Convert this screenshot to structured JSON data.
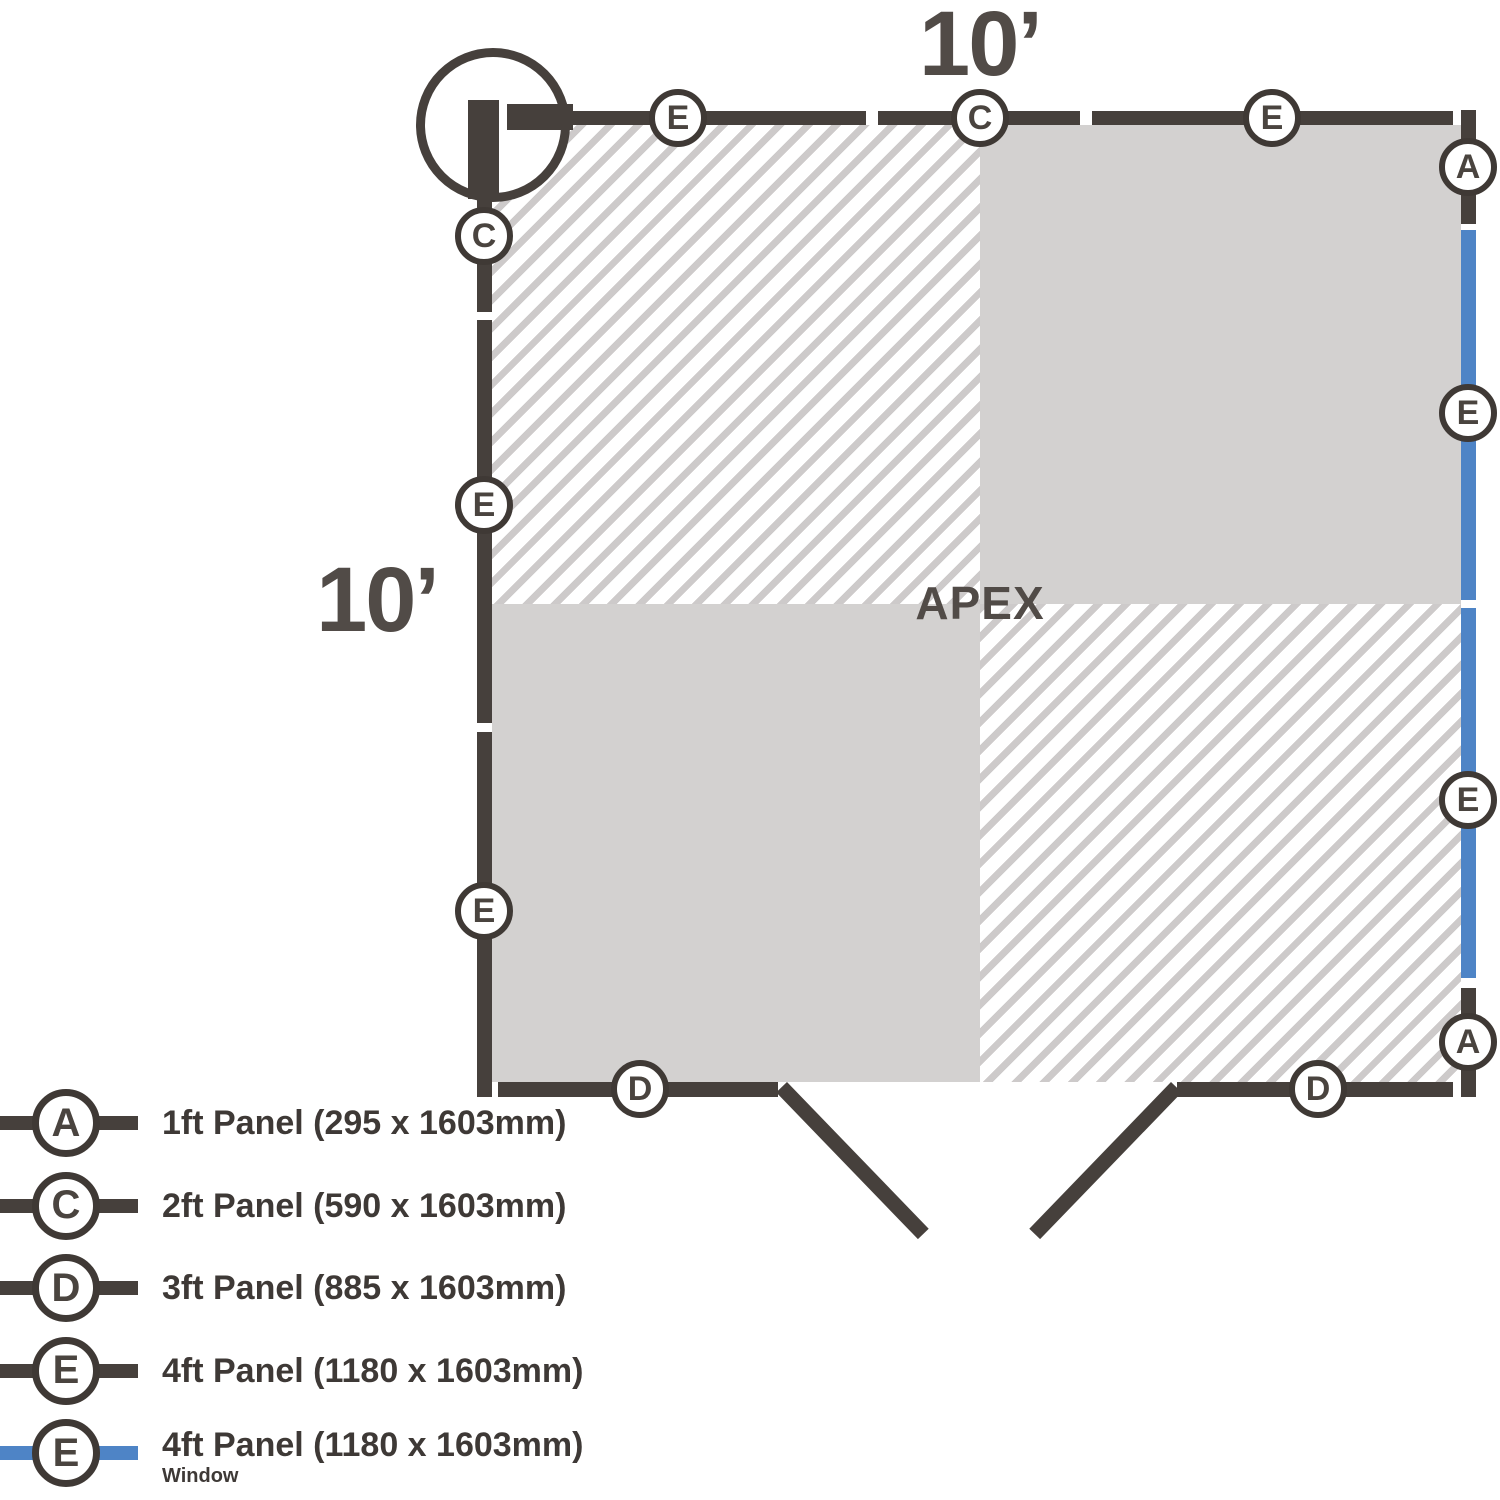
{
  "diagram": {
    "top_dimension": "10’",
    "left_dimension": "10’",
    "apex_label": "APEX"
  },
  "colors": {
    "wall": "#46403C",
    "window": "#4E84C6",
    "floor": "#D3D1D0",
    "hatch": "#CDCACA",
    "text": "#514B47",
    "legend_text": "#3E3936"
  },
  "markers": [
    {
      "letter": "E",
      "side": "top",
      "x": 678,
      "y": 118
    },
    {
      "letter": "C",
      "side": "top",
      "x": 980,
      "y": 118
    },
    {
      "letter": "E",
      "side": "top",
      "x": 1272,
      "y": 118
    },
    {
      "letter": "A",
      "side": "right",
      "x": 1468,
      "y": 167
    },
    {
      "letter": "E",
      "side": "right",
      "x": 1468,
      "y": 413
    },
    {
      "letter": "E",
      "side": "right",
      "x": 1468,
      "y": 800
    },
    {
      "letter": "A",
      "side": "right",
      "x": 1468,
      "y": 1042
    },
    {
      "letter": "C",
      "side": "left",
      "x": 484,
      "y": 236
    },
    {
      "letter": "E",
      "side": "left",
      "x": 484,
      "y": 505
    },
    {
      "letter": "E",
      "side": "left",
      "x": 484,
      "y": 911
    },
    {
      "letter": "D",
      "side": "bottom",
      "x": 640,
      "y": 1089
    },
    {
      "letter": "D",
      "side": "bottom",
      "x": 1318,
      "y": 1089
    }
  ],
  "legend": {
    "items": [
      {
        "letter": "A",
        "label": "1ft Panel (295 x 1603mm)",
        "line": "wall"
      },
      {
        "letter": "C",
        "label": "2ft Panel (590 x 1603mm)",
        "line": "wall"
      },
      {
        "letter": "D",
        "label": "3ft Panel (885 x 1603mm)",
        "line": "wall"
      },
      {
        "letter": "E",
        "label": "4ft Panel (1180 x 1603mm)",
        "line": "wall"
      },
      {
        "letter": "E",
        "label": "4ft Panel (1180 x 1603mm)",
        "sublabel": "Window",
        "line": "window"
      }
    ]
  }
}
